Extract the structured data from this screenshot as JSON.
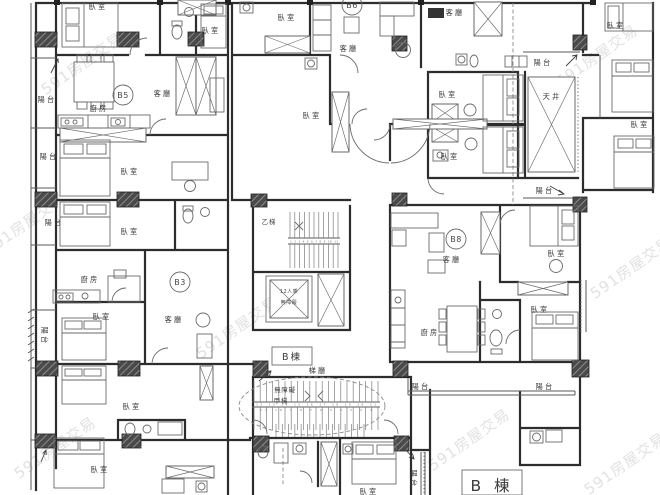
{
  "plan": {
    "building": {
      "label_small": "B棟",
      "label_large": "B 棟"
    },
    "units": {
      "b3": "B3",
      "b5": "B5",
      "b6": "B6",
      "b8": "B8"
    },
    "rooms": {
      "bedroom": "臥室",
      "living_room": "客廳",
      "kitchen": "廚房",
      "balcony": "陽台",
      "light_well": "天井",
      "stair_hall": "梯廳",
      "stair_a": "甲梯",
      "stair_b": "乙梯",
      "barrier_free": "無障礙"
    },
    "elevator": {
      "line1": "12人乘",
      "line2": "無障礙"
    },
    "stair_numbers": {
      "a_upper": "12 13 14 15 16 17 18 19 20 21",
      "a_lower": "11 10 9 8 7 6 5 4 3 2 1",
      "b_row": "1 2 3 4 5 6 7 8 9 10 11"
    },
    "watermark": "591房屋交易"
  }
}
